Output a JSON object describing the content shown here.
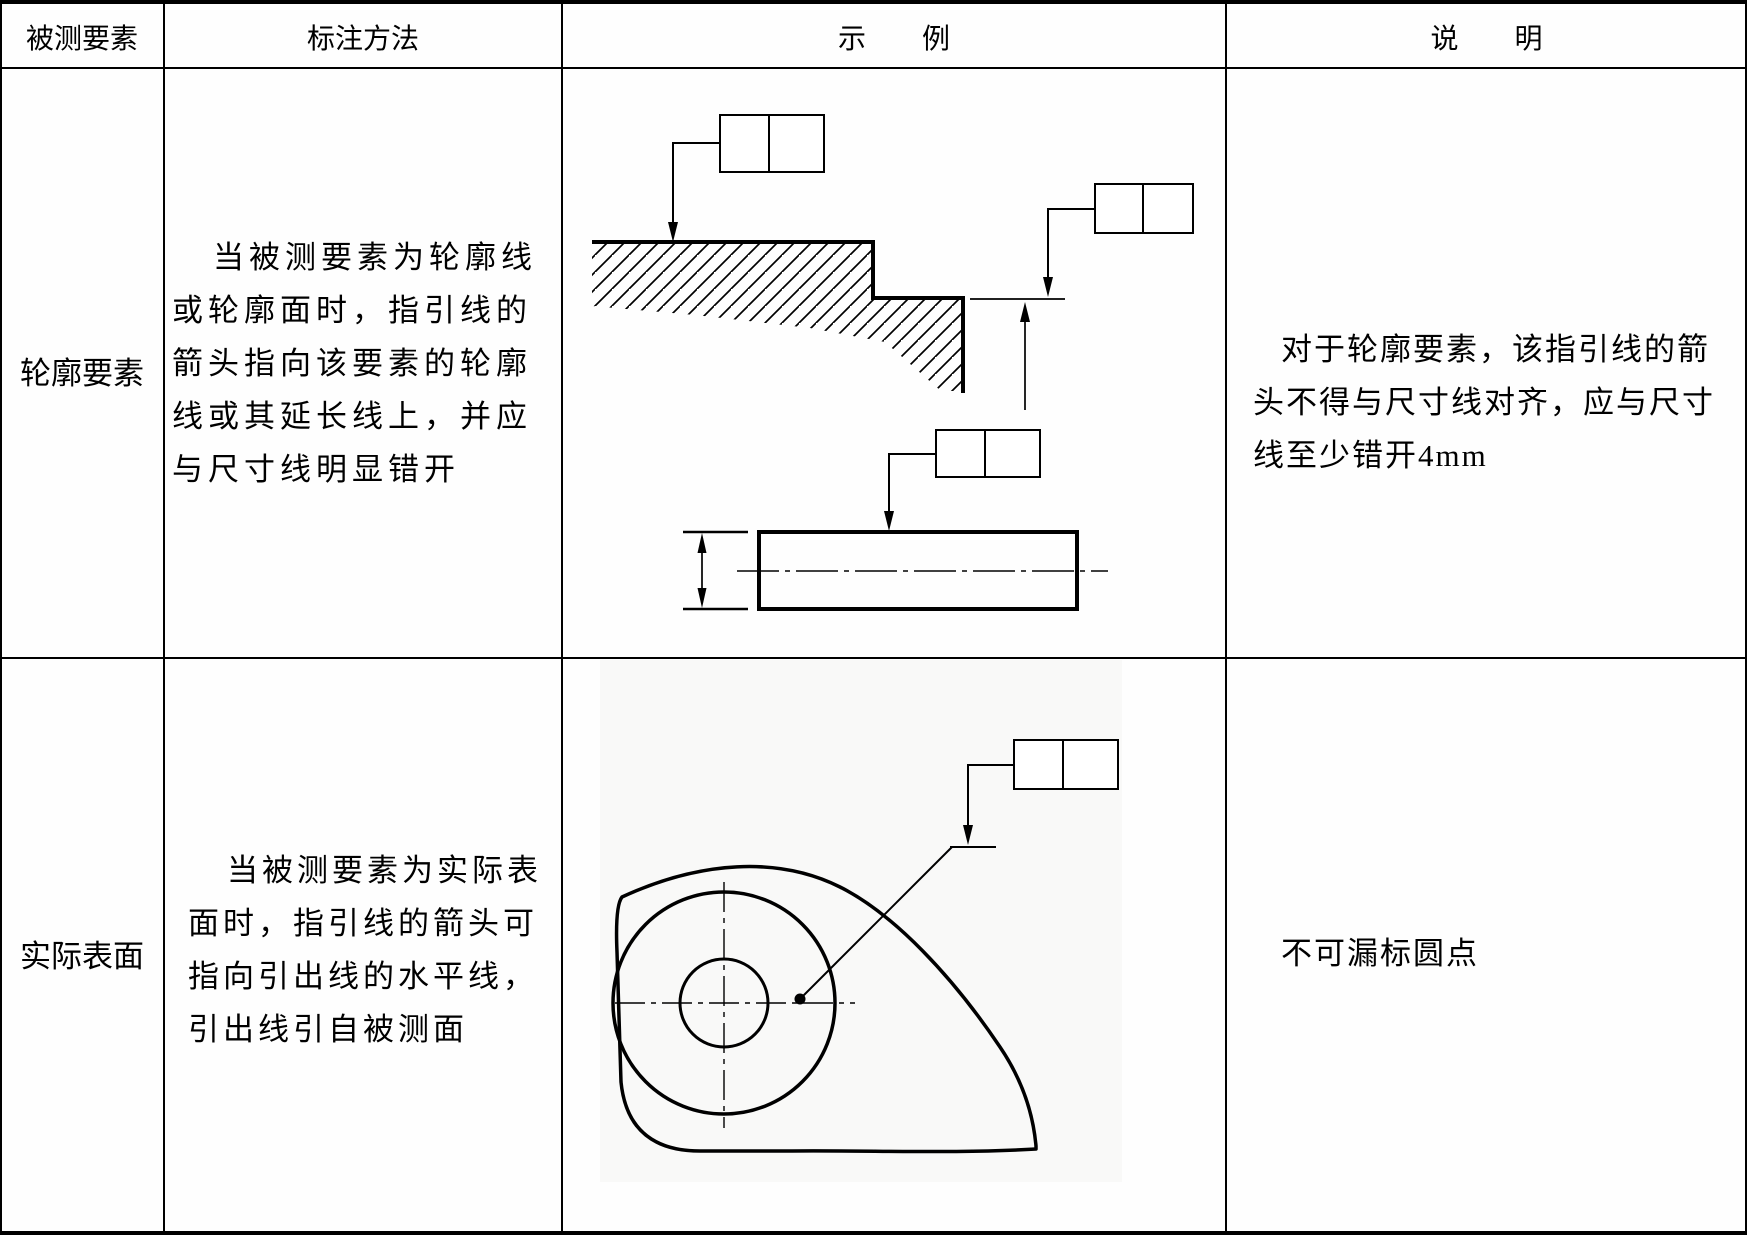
{
  "table": {
    "headers": [
      {
        "label": "被测要素"
      },
      {
        "label": "标注方法"
      },
      {
        "label": "示　例"
      },
      {
        "label": "说　明"
      }
    ],
    "rows": [
      {
        "element": "轮廓要素",
        "method_lines": [
          "当被测要素为轮廓线",
          "或轮廓面时，指引线的",
          "箭头指向该要素的轮廓",
          "线或其延长线上，并应",
          "与尺寸线明显错开"
        ],
        "note_lines": [
          "对于轮廓要素，该指引线的箭",
          "头不得与尺寸线对齐，应与尺寸",
          "线至少错开4mm"
        ]
      },
      {
        "element": "实际表面",
        "method_lines": [
          "当被测要素为实际表",
          "面时，指引线的箭头可",
          "指向引出线的水平线，",
          "引出线引自被测面"
        ],
        "note_lines": [
          "不可漏标圆点"
        ]
      }
    ],
    "colors": {
      "line": "#000000",
      "background": "#fefefe"
    }
  }
}
